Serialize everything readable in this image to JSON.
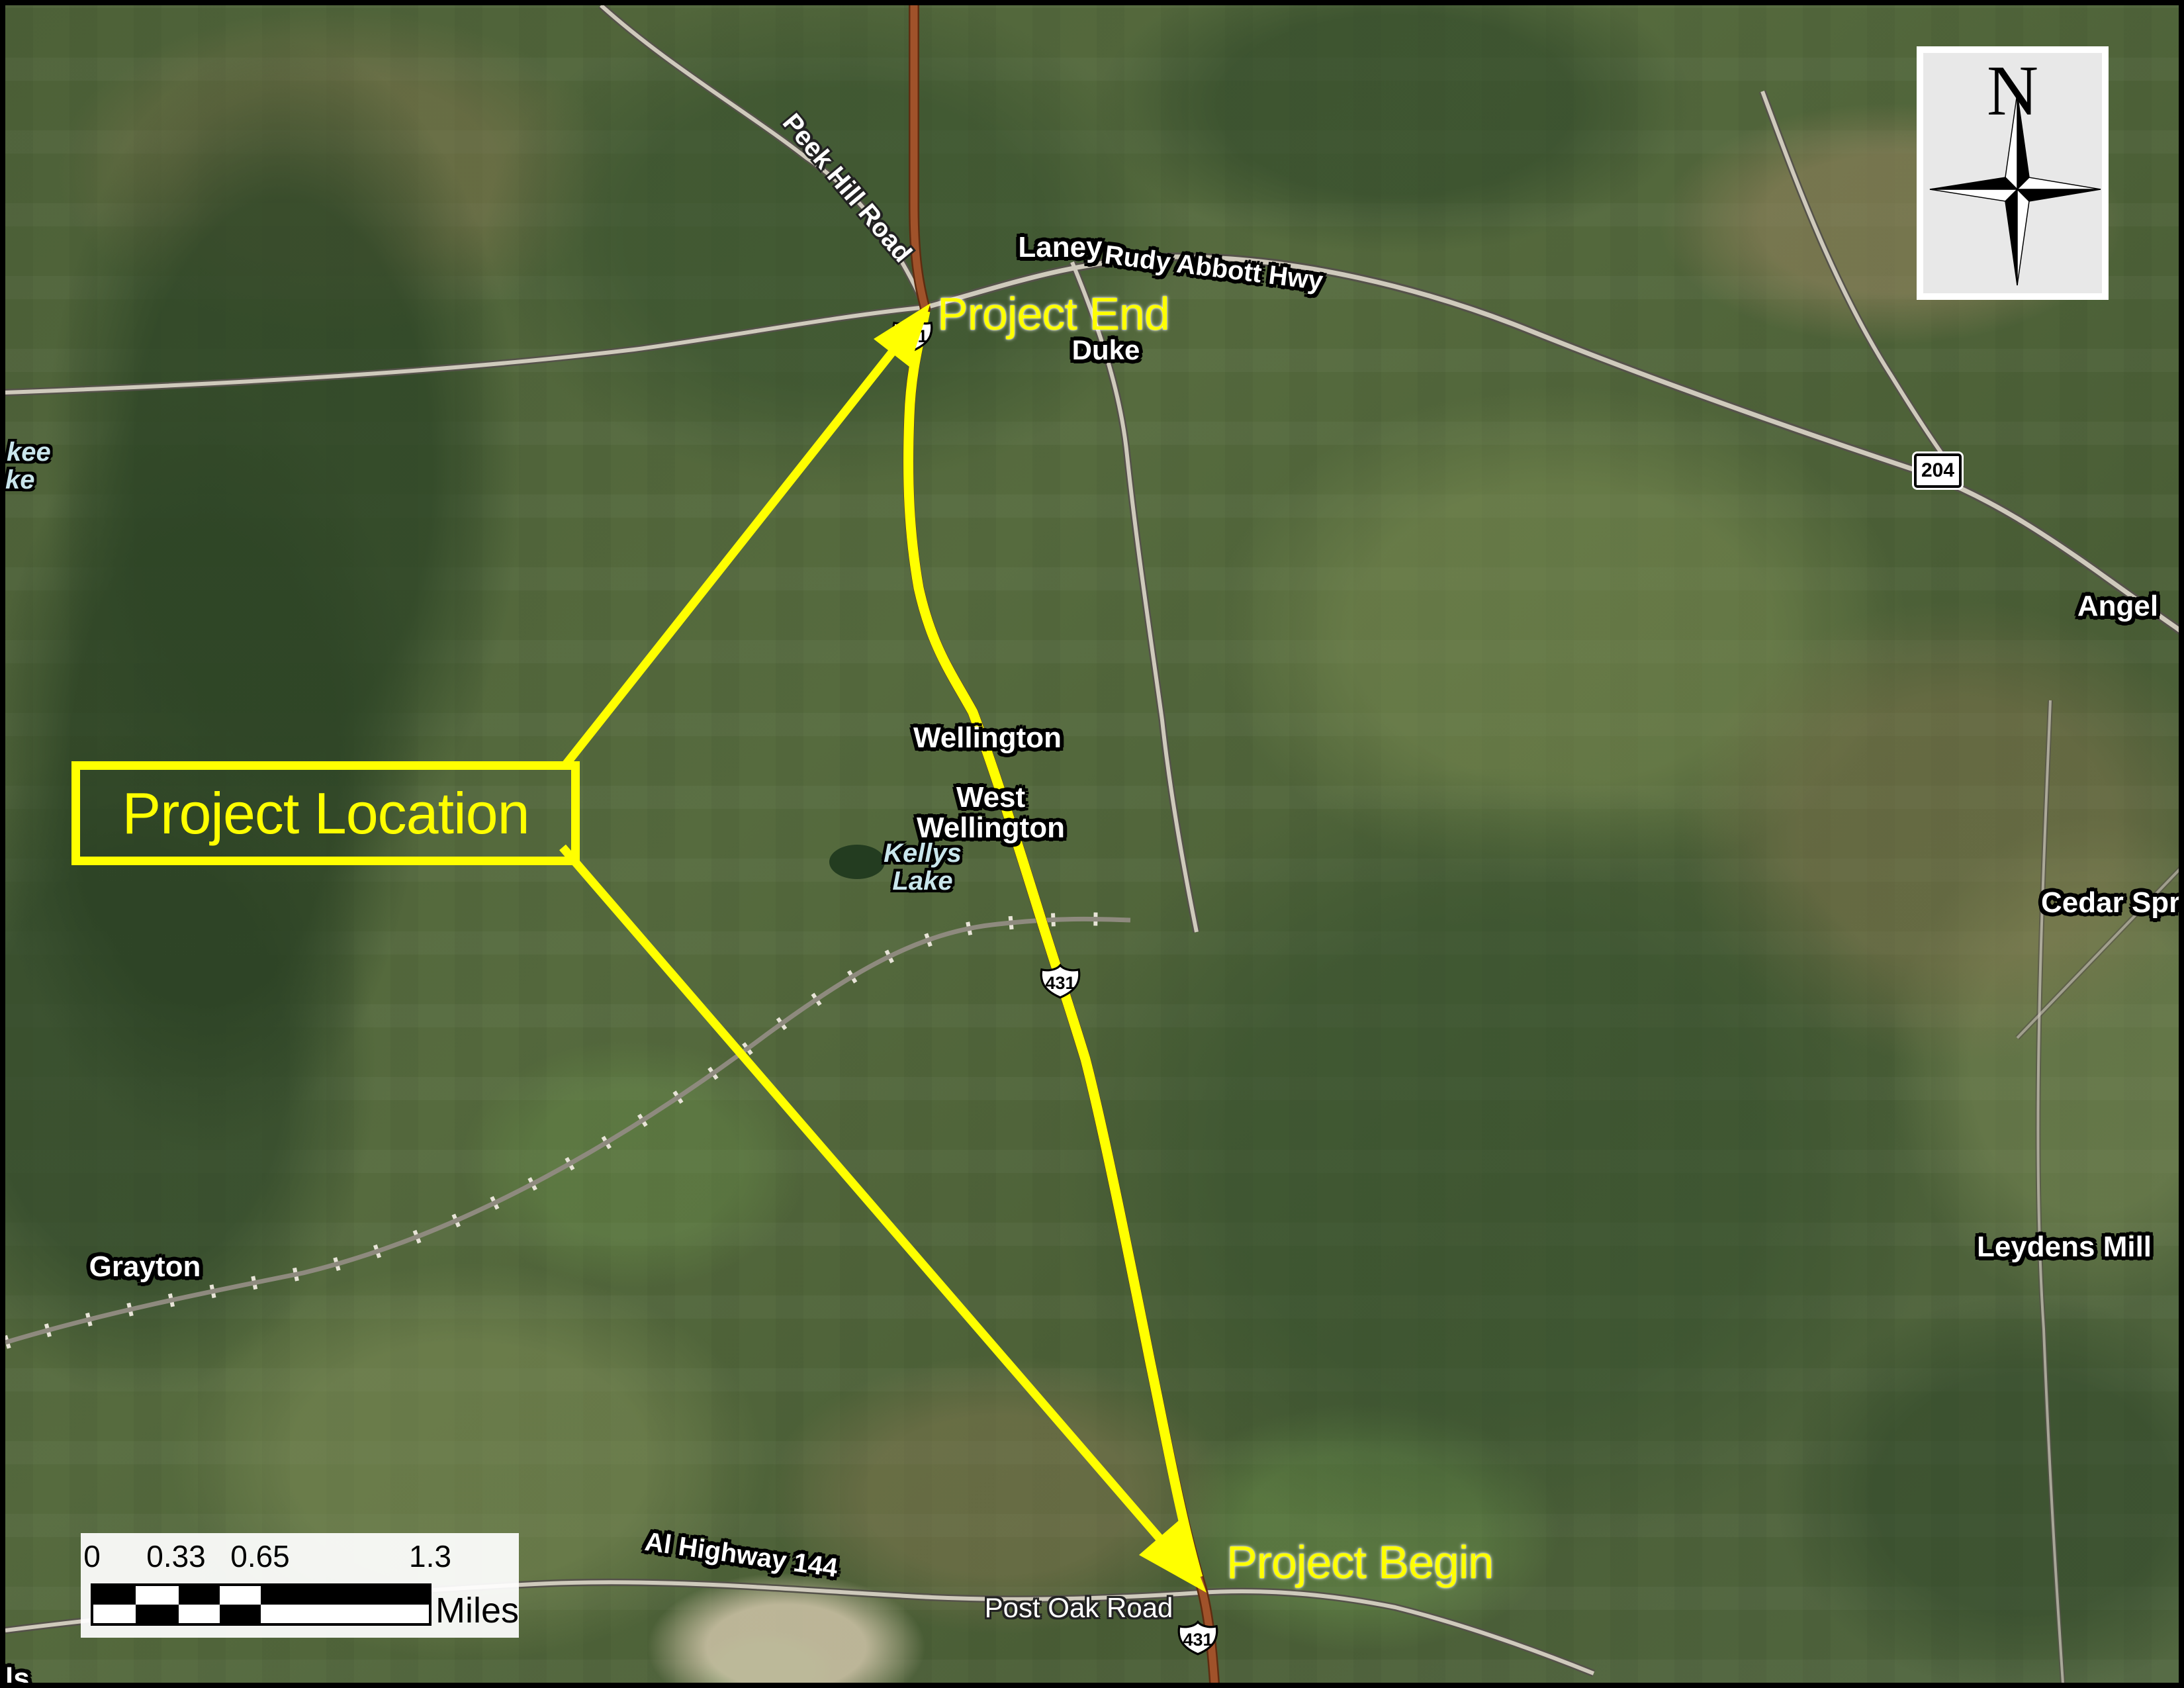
{
  "colors": {
    "highlight_yellow": "#ffff00",
    "route431_brown": "#a0522a",
    "road_gray": "#cfcabc",
    "water_label_blue": "#c9e6ec",
    "north_box_gray": "#e8e8e8"
  },
  "overlay": {
    "project_location": "Project Location",
    "project_end": "Project End",
    "project_begin": "Project Begin"
  },
  "places": {
    "laney": "Laney",
    "duke": "Duke",
    "wellington": "Wellington",
    "west_wellington": "West Wellington",
    "kellys_lake": "Kellys Lake",
    "grayton": "Grayton",
    "angel": "Angel",
    "cedar_springs": "Cedar Spr",
    "leydens_mill": "Leydens Mill",
    "lake_fragment_1": "kee",
    "lake_fragment_2": "ke",
    "town_fragment": "ls"
  },
  "road_labels": {
    "peek_hill": "Peek Hill Road",
    "rudy_abbott": "Rudy Abbott Hwy",
    "al_144": "Al Highway 144",
    "post_oak": "Post Oak Road"
  },
  "shields": {
    "us431": "431",
    "sr204": "204"
  },
  "scale_bar": {
    "ticks": [
      "0",
      "0.33",
      "0.65",
      "1.3"
    ],
    "unit": "Miles"
  },
  "north_arrow": {
    "label": "N"
  }
}
